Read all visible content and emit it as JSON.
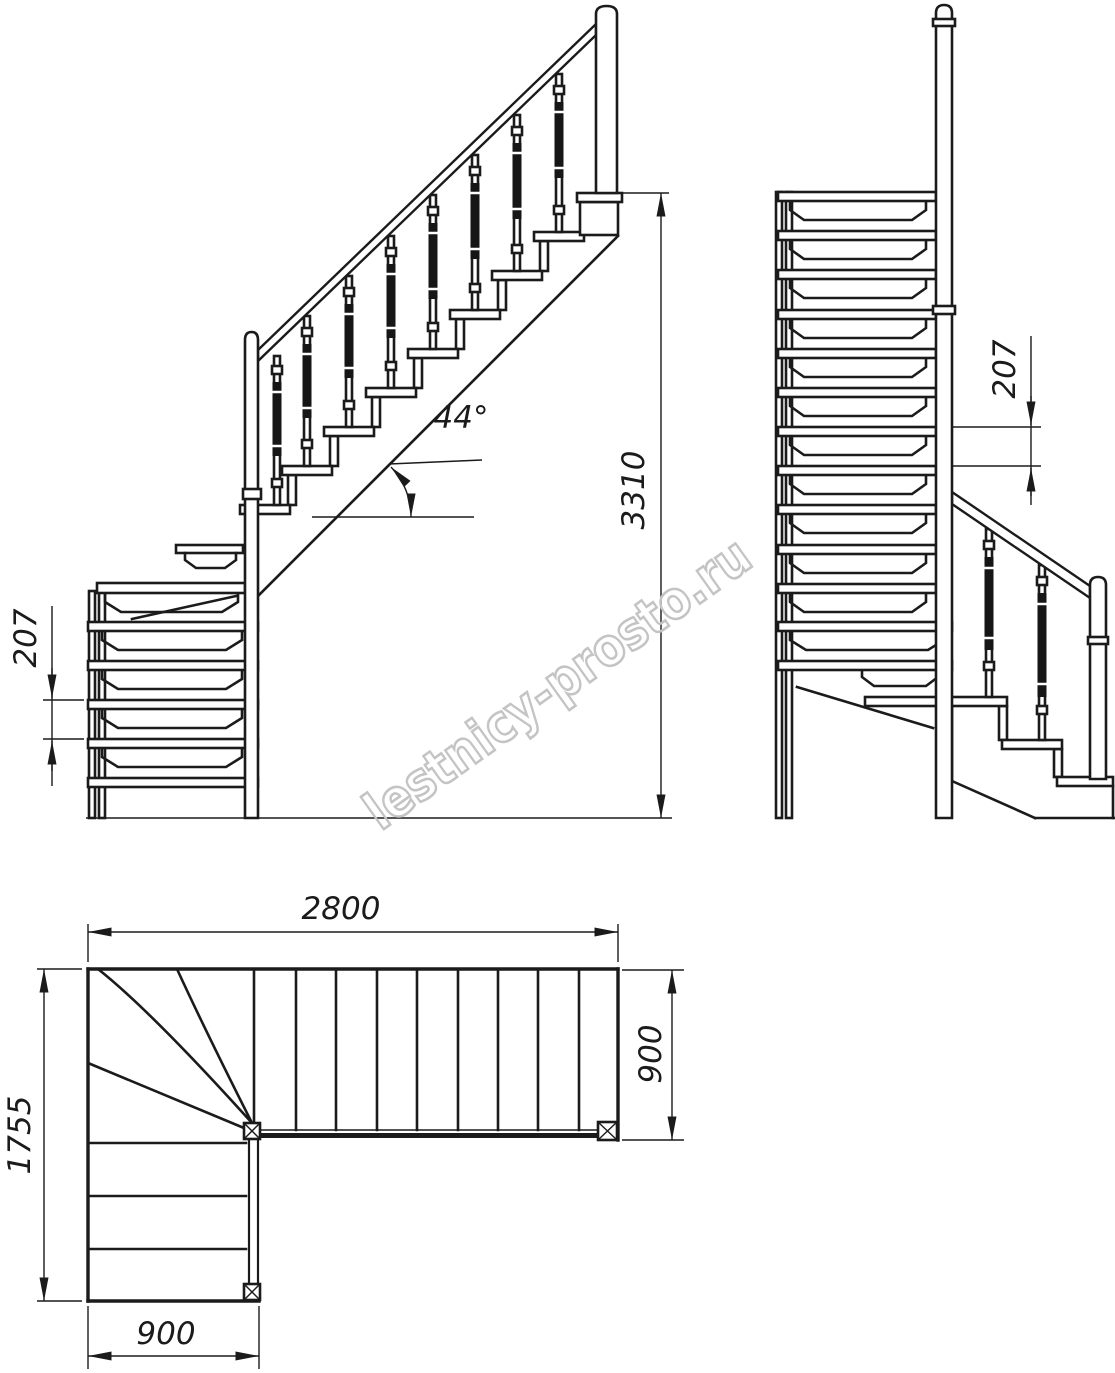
{
  "sheet": {
    "background": "#ffffff"
  },
  "watermark": {
    "text": "lestnicy-prosto.ru",
    "color": "#c4c4c4"
  },
  "dimensions": {
    "total_height": "3310",
    "riser_height_front": "207",
    "riser_height_side": "207",
    "incline_angle": "44°",
    "plan_total_length": "2800",
    "plan_flight_width": "900",
    "plan_total_depth": "1755",
    "plan_lower_flight_width": "900"
  },
  "colors": {
    "line": "#1b1b1b"
  }
}
